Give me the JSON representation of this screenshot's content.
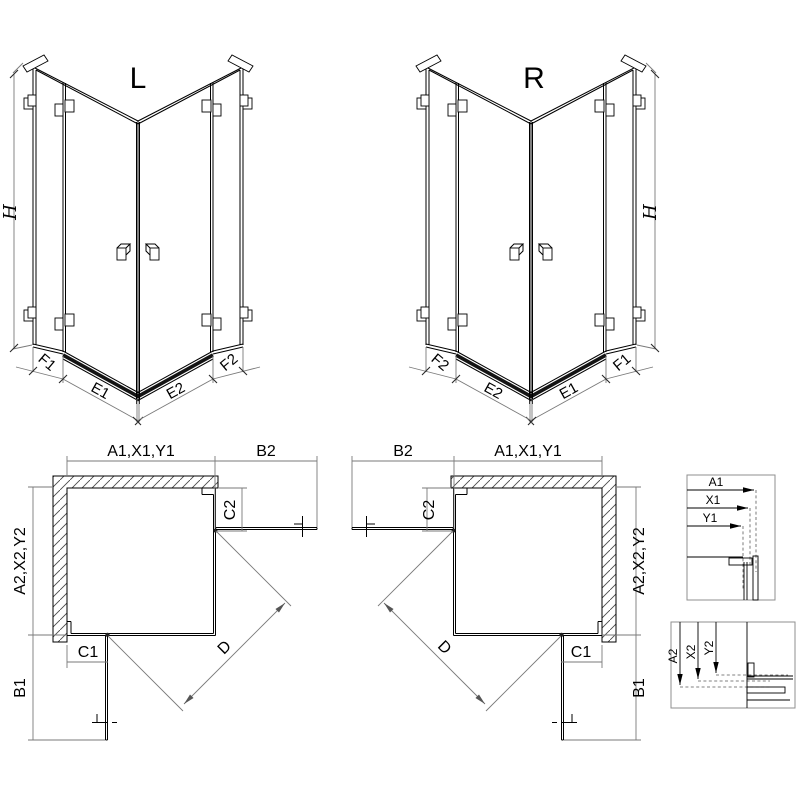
{
  "figure": {
    "iso_left": {
      "label": "L",
      "height": "H",
      "f1": "F1",
      "e1": "E1",
      "e2": "E2",
      "f2": "F2"
    },
    "iso_right": {
      "label": "R",
      "height": "H",
      "f1": "F1",
      "e1": "E1",
      "e2": "E2",
      "f2": "F2"
    },
    "plan_left": {
      "top_width": "A1,X1,Y1",
      "door_width": "B2",
      "fixed_right": "C2",
      "side_depth": "A2,X2,Y2",
      "fixed_bottom": "C1",
      "door_depth": "B1",
      "entry_diagonal": "D"
    },
    "plan_right": {
      "top_width": "A1,X1,Y1",
      "door_width": "B2",
      "fixed_left": "C2",
      "side_depth": "A2,X2,Y2",
      "fixed_bottom": "C1",
      "door_depth": "B1",
      "entry_diagonal": "D"
    },
    "detail_top": {
      "a1": "A1",
      "x1": "X1",
      "y1": "Y1"
    },
    "detail_bottom": {
      "a2": "A2",
      "x2": "X2",
      "y2": "Y2"
    },
    "colors": {
      "ink": "#000000",
      "dimension": "#7a7a7a",
      "background": "#ffffff"
    }
  }
}
